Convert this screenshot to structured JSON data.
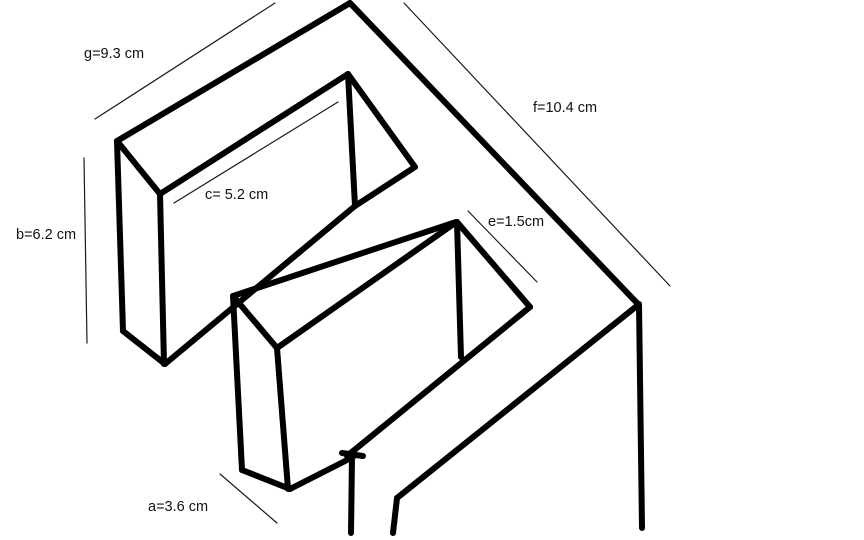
{
  "title": "Hand-drawn isometric sketch of a stepped solid with dimension labels",
  "canvas": {
    "width": 864,
    "height": 540,
    "background": "#ffffff"
  },
  "colors": {
    "stroke": "#000000",
    "thin_stroke": "#1a1a1a",
    "label_text": "#111111"
  },
  "dimensions": {
    "g": {
      "text": "g=9.3 cm",
      "value": 9.3,
      "unit": "cm",
      "x": 84,
      "y": 46
    },
    "f": {
      "text": "f=10.4 cm",
      "value": 10.4,
      "unit": "cm",
      "x": 533,
      "y": 100
    },
    "c": {
      "text": "c= 5.2 cm",
      "value": 5.2,
      "unit": "cm",
      "x": 205,
      "y": 187
    },
    "b": {
      "text": "b=6.2 cm",
      "value": 6.2,
      "unit": "cm",
      "x": 16,
      "y": 227
    },
    "e": {
      "text": "e=1.5cm",
      "value": 1.5,
      "unit": "cm",
      "x": 488,
      "y": 214
    },
    "a": {
      "text": "a=3.6 cm",
      "value": 3.6,
      "unit": "cm",
      "x": 148,
      "y": 499
    }
  },
  "sketch": {
    "thick_stroke_width": 6,
    "thin_stroke_width": 1.2,
    "thick_segments": [
      {
        "name": "upper-box-outer-top-edge",
        "x1": 117,
        "y1": 141,
        "x2": 350,
        "y2": 3
      },
      {
        "name": "plate-right-top-edge",
        "x1": 350,
        "y1": 3,
        "x2": 638,
        "y2": 304
      },
      {
        "name": "upper-box-front-top-left-edge",
        "x1": 117,
        "y1": 141,
        "x2": 160,
        "y2": 194
      },
      {
        "name": "upper-box-inner-top-edge",
        "x1": 160,
        "y1": 194,
        "x2": 348,
        "y2": 74
      },
      {
        "name": "upper-box-inner-right-edge",
        "x1": 348,
        "y1": 74,
        "x2": 415,
        "y2": 167
      },
      {
        "name": "upper-box-inner-corner-vertical",
        "x1": 348,
        "y1": 74,
        "x2": 355,
        "y2": 206
      },
      {
        "name": "upper-box-inner-floor-right-edge",
        "x1": 415,
        "y1": 167,
        "x2": 355,
        "y2": 206
      },
      {
        "name": "upper-box-floor-front-edge",
        "x1": 355,
        "y1": 206,
        "x2": 165,
        "y2": 364
      },
      {
        "name": "upper-box-outer-left-vertical",
        "x1": 117,
        "y1": 141,
        "x2": 123,
        "y2": 331
      },
      {
        "name": "upper-box-inner-left-vertical",
        "x1": 160,
        "y1": 194,
        "x2": 164,
        "y2": 364
      },
      {
        "name": "upper-box-bottom-left-edge",
        "x1": 123,
        "y1": 331,
        "x2": 165,
        "y2": 364
      },
      {
        "name": "plate-right-vertical-edge",
        "x1": 639,
        "y1": 304,
        "x2": 642,
        "y2": 528
      },
      {
        "name": "plate-front-top-edge",
        "x1": 638,
        "y1": 305,
        "x2": 397,
        "y2": 498
      },
      {
        "name": "plate-front-left-vertical",
        "x1": 397,
        "y1": 498,
        "x2": 393,
        "y2": 533
      },
      {
        "name": "base-front-corner-vertical",
        "x1": 352,
        "y1": 456,
        "x2": 351,
        "y2": 533
      },
      {
        "name": "base-corner-tick",
        "x1": 342,
        "y1": 453,
        "x2": 363,
        "y2": 456
      },
      {
        "name": "base-bottom-left-edge",
        "x1": 353,
        "y1": 457,
        "x2": 290,
        "y2": 489
      },
      {
        "name": "lower-box-back-top-edge",
        "x1": 233,
        "y1": 296,
        "x2": 456,
        "y2": 222
      },
      {
        "name": "lower-box-front-top-left-edge",
        "x1": 233,
        "y1": 296,
        "x2": 277,
        "y2": 348
      },
      {
        "name": "lower-box-inner-top-edge",
        "x1": 277,
        "y1": 348,
        "x2": 455,
        "y2": 223
      },
      {
        "name": "lower-box-right-top-edge",
        "x1": 457,
        "y1": 222,
        "x2": 530,
        "y2": 307
      },
      {
        "name": "lower-box-inner-corner-vertical",
        "x1": 457,
        "y1": 222,
        "x2": 461,
        "y2": 357
      },
      {
        "name": "lower-box-right-floor-edge",
        "x1": 530,
        "y1": 307,
        "x2": 347,
        "y2": 456
      },
      {
        "name": "lower-box-outer-left-vertical",
        "x1": 233,
        "y1": 296,
        "x2": 242,
        "y2": 470
      },
      {
        "name": "lower-box-inner-left-vertical",
        "x1": 277,
        "y1": 348,
        "x2": 288,
        "y2": 489
      },
      {
        "name": "lower-box-bottom-left-edge",
        "x1": 242,
        "y1": 470,
        "x2": 290,
        "y2": 489
      }
    ],
    "thin_segments": [
      {
        "name": "dim-line-g",
        "x1": 95,
        "y1": 119,
        "x2": 275,
        "y2": 3
      },
      {
        "name": "dim-line-f",
        "x1": 404,
        "y1": 3,
        "x2": 670,
        "y2": 286
      },
      {
        "name": "dim-line-c",
        "x1": 174,
        "y1": 203,
        "x2": 338,
        "y2": 102
      },
      {
        "name": "dim-line-b",
        "x1": 84,
        "y1": 158,
        "x2": 87,
        "y2": 343
      },
      {
        "name": "dim-line-e",
        "x1": 468,
        "y1": 211,
        "x2": 537,
        "y2": 282
      },
      {
        "name": "dim-line-a",
        "x1": 220,
        "y1": 474,
        "x2": 277,
        "y2": 523
      }
    ]
  }
}
